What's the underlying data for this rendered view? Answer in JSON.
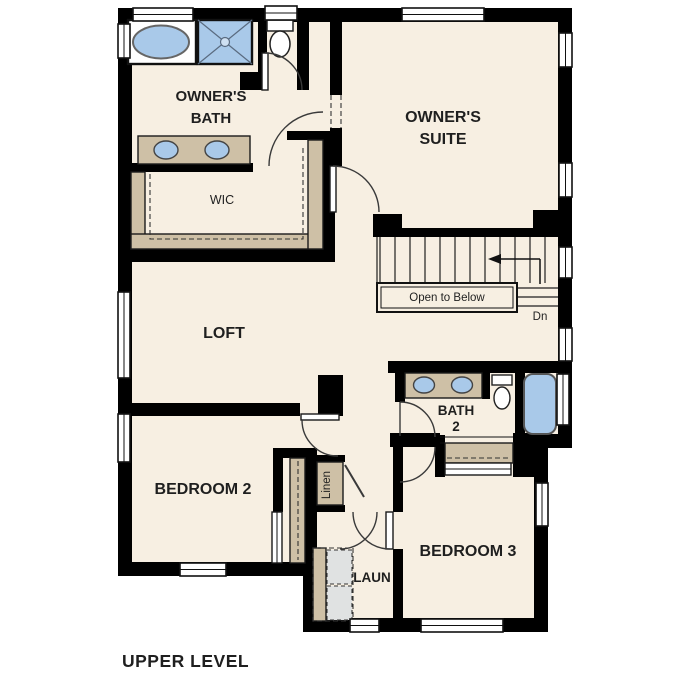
{
  "plan": {
    "level_title": "UPPER LEVEL"
  },
  "rooms": {
    "owners_bath": {
      "name_line1": "OWNER'S",
      "name_line2": "BATH"
    },
    "owners_suite": {
      "name_line1": "OWNER'S",
      "name_line2": "SUITE"
    },
    "wic": {
      "name": "WIC"
    },
    "loft": {
      "name": "LOFT"
    },
    "bath_2": {
      "name_line1": "BATH",
      "name_line2": "2"
    },
    "bedroom_2": {
      "name": "BEDROOM 2"
    },
    "bedroom_3": {
      "name": "BEDROOM 3"
    },
    "laundry": {
      "name": "LAUN"
    },
    "linen": {
      "name": "Linen"
    }
  },
  "stairs": {
    "open_to_below_label": "Open to Below",
    "down_label": "Dn"
  },
  "fixtures": [
    "bathtub-icon",
    "shower-icon",
    "toilet-icon",
    "double-sink-vanity-icon",
    "soaking-tub-icon",
    "washer-dryer-icon",
    "closet-rod-dashes",
    "stair-treads"
  ],
  "colors": {
    "floor": "#f7efe2",
    "casework": "#cec0a6",
    "fixture_blue": "#a9c9e9",
    "wall": "#000000",
    "appliance_gray": "#e0e2e2",
    "line": "#333333"
  }
}
